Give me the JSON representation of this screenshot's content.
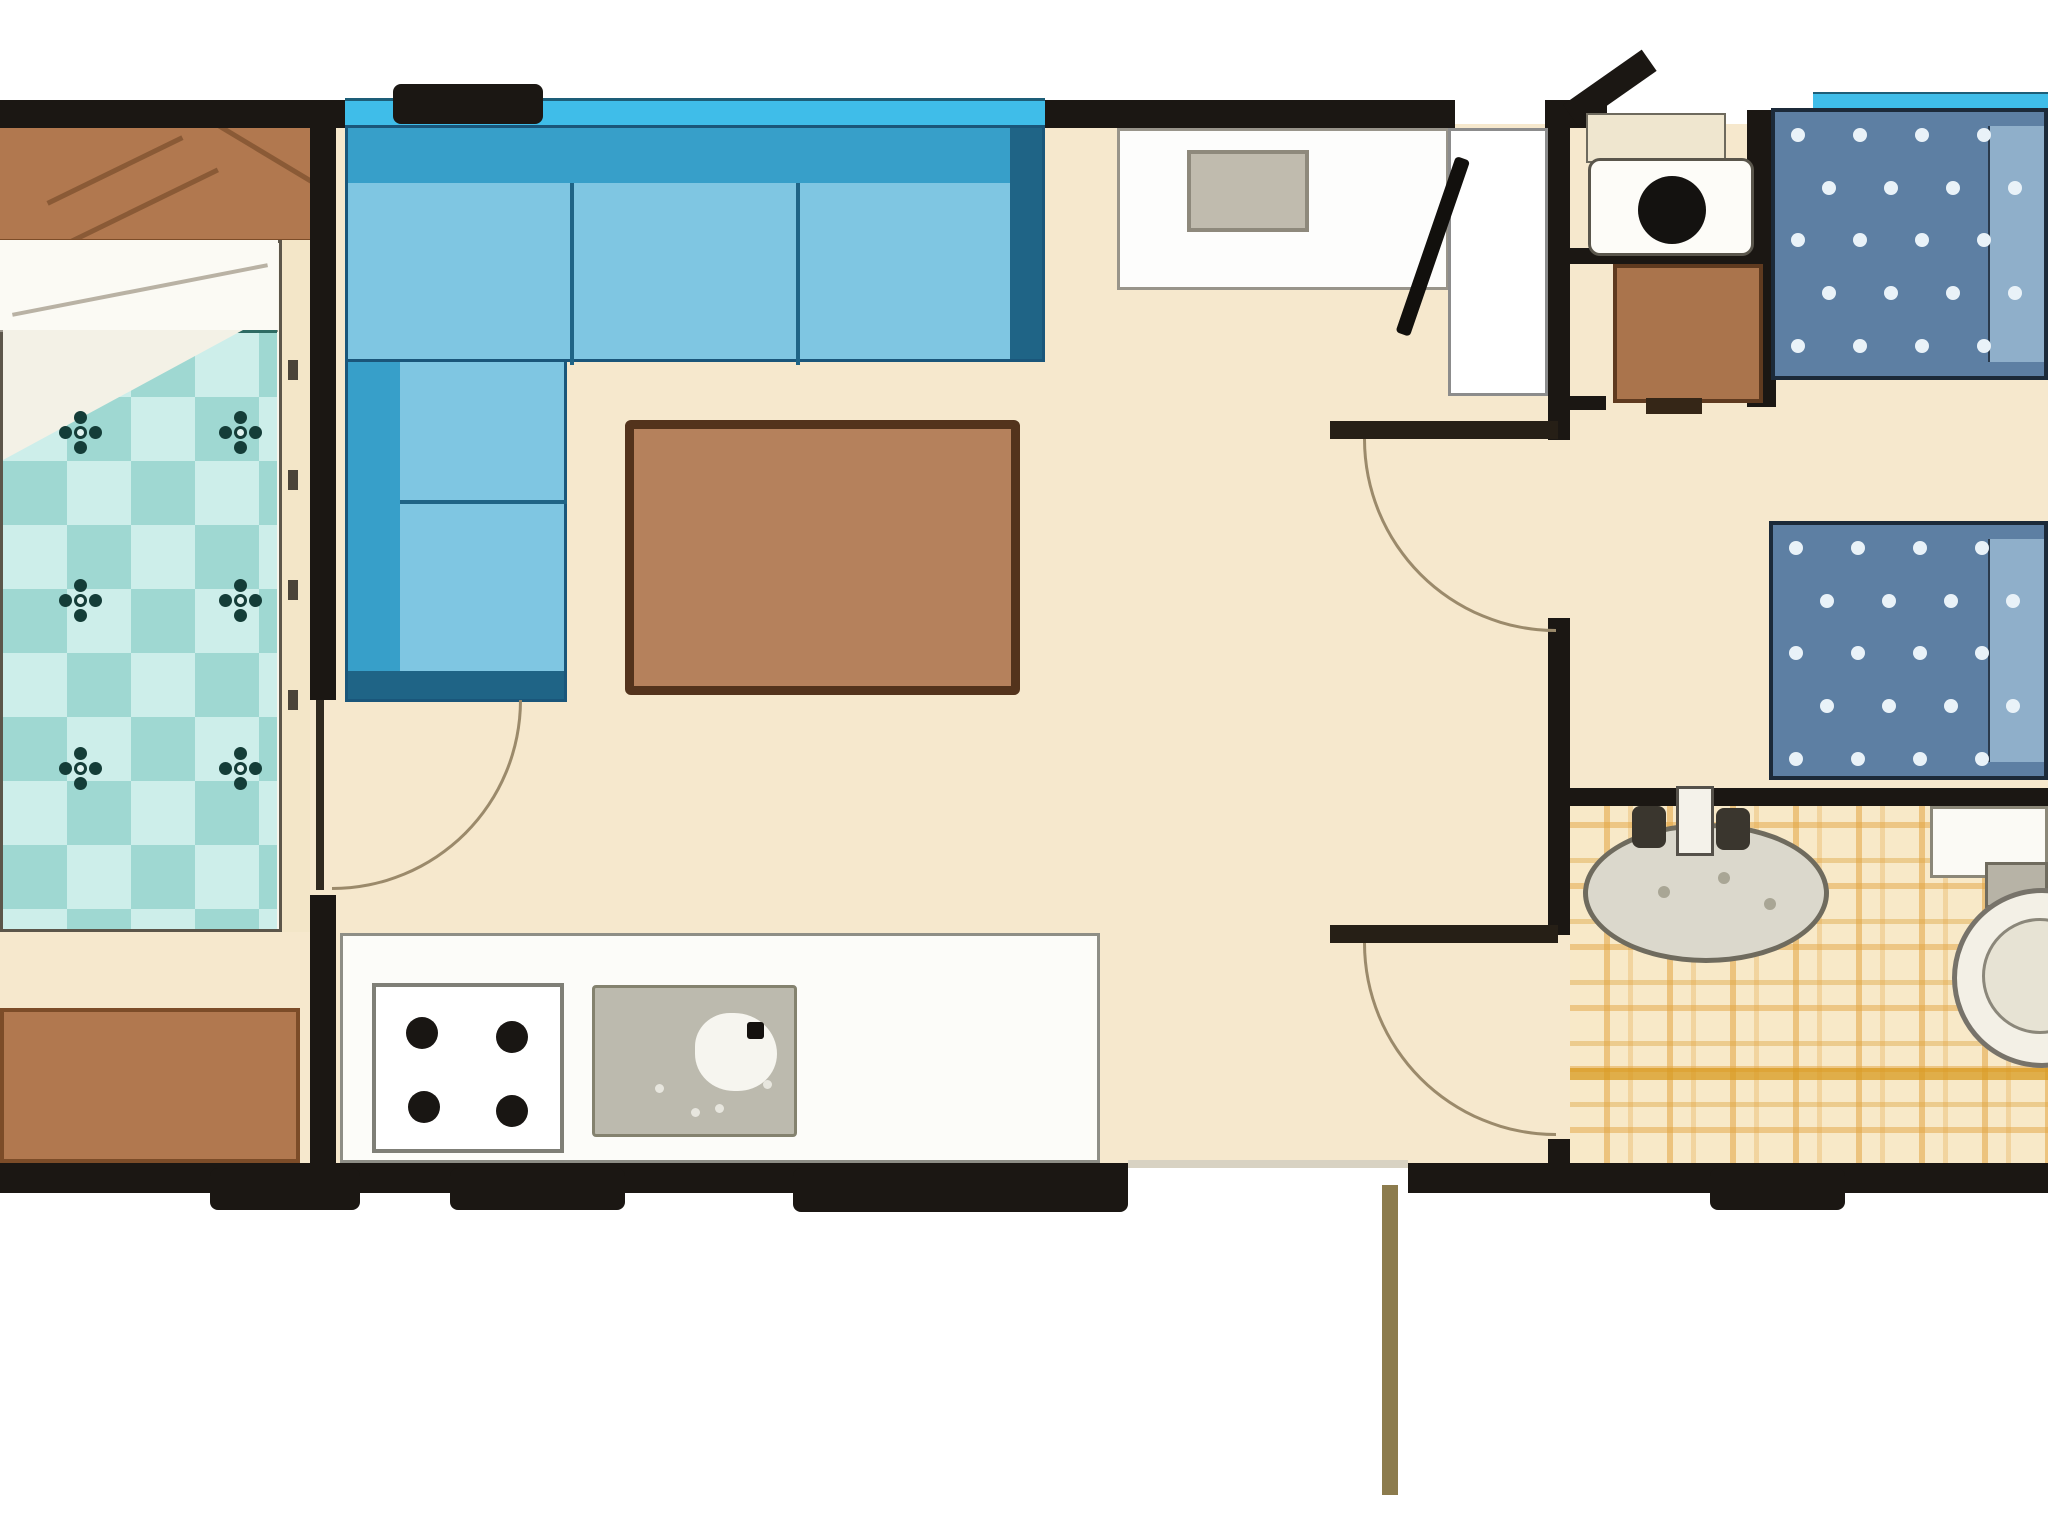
{
  "app": {
    "title": "Static caravan floor plan",
    "type": "floor-plan-diagram",
    "visible_text": []
  },
  "palette": {
    "wall": "#1b1713",
    "cream": "#f6e8cd",
    "wood": "#b1784f",
    "woodDark": "#7c4c28",
    "woodLine": "#8a5a36",
    "table": "#b5815c",
    "tableBorder": "#53331c",
    "sofaSeat": "#7fc6e2",
    "sofaBack": "#379fc9",
    "sofaDark": "#1f6486",
    "cyan": "#3fbde9",
    "duvetA": "#cdeeea",
    "duvetB": "#9fd8d2",
    "duvetOutline": "#2e6b64",
    "flower": "#143d38",
    "mattress": "#5d7fa3",
    "pillowBlue": "#8fafca",
    "counter": "#fcfcf9",
    "sinkGray": "#bcbaae",
    "sinkEdge": "#84826f",
    "tileBase": "#f8e9c8",
    "bench": "#fdfdfc",
    "cushion": "#c0bbae",
    "cushionEdge": "#8e897c",
    "arc": "#9b8a6b",
    "olive": "#8c7b4d"
  },
  "rooms": [
    {
      "name": "double-bedroom",
      "furniture": [
        "overhead-wardrobe",
        "double-bed-checkered-duvet",
        "bedside-strip",
        "drawer-chest"
      ]
    },
    {
      "name": "lounge",
      "furniture": [
        "l-shaped-sofa",
        "coffee-table",
        "window-strip"
      ]
    },
    {
      "name": "kitchen",
      "furniture": [
        "worktop",
        "four-burner-hob",
        "sink-drainer"
      ]
    },
    {
      "name": "hall-dining",
      "furniture": [
        "bench-seat-with-cushion",
        "main-entrance-door",
        "rear-entrance-door"
      ]
    },
    {
      "name": "wc-vanity-room",
      "furniture": [
        "cistern",
        "basin-unit",
        "storage-cabinet"
      ]
    },
    {
      "name": "twin-bedroom",
      "furniture": [
        "single-bed-1-polka",
        "single-bed-2-polka"
      ]
    },
    {
      "name": "bathroom",
      "furniture": [
        "oval-basin",
        "faucet",
        "vanity-shelf",
        "toilet",
        "plaid-tile-floor"
      ]
    }
  ],
  "doors": [
    {
      "name": "bedroom-door",
      "swing": "quarter-arc"
    },
    {
      "name": "corridor-door",
      "swing": "quarter-arc"
    },
    {
      "name": "bathroom-door",
      "swing": "quarter-arc"
    },
    {
      "name": "main-entrance-door",
      "state": "open"
    },
    {
      "name": "rear-entrance-door",
      "state": "open"
    }
  ],
  "decor": {
    "duvet_flowers": {
      "cols": [
        80,
        240
      ],
      "rows": [
        432,
        600,
        768
      ]
    },
    "polka": {
      "spacing": 62,
      "radius": 7
    },
    "burners": [
      [
        46,
        46
      ],
      [
        136,
        50
      ],
      [
        48,
        120
      ],
      [
        136,
        124
      ]
    ],
    "ksink_dots": [
      [
        60,
        96
      ],
      [
        120,
        116
      ],
      [
        168,
        92
      ],
      [
        96,
        120
      ]
    ],
    "bsink_specks": [
      [
        70,
        58
      ],
      [
        130,
        44
      ],
      [
        176,
        70
      ]
    ]
  }
}
